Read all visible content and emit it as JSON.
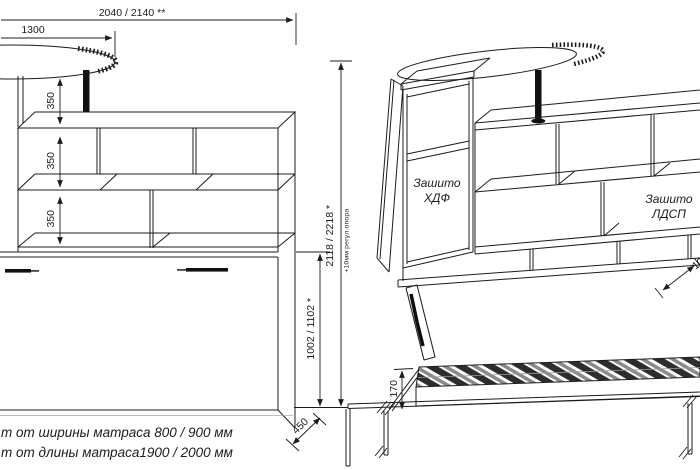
{
  "views": {
    "front": {
      "dims": {
        "total_width": "2040 / 2140 **",
        "table_width": "1300",
        "shelf_spacing": [
          "350",
          "350",
          "350"
        ],
        "bed_cabinet_height": "1002 / 1102 *",
        "total_height": "2118 / 2218 *",
        "total_height_note": "+10мм регул.опора",
        "depth": "450"
      }
    },
    "side": {
      "labels": {
        "hdf": "Зашито ХДФ",
        "ldsp": "Зашито ЛДСП"
      },
      "dims": {
        "frame_height": "170",
        "clearance": "100"
      }
    }
  },
  "footnotes": [
    "т от ширины матраса 800 / 900 мм",
    "т от длины матраса1900 / 2000 мм"
  ],
  "colors": {
    "line": "#1c1c1c",
    "slat_dark": "#2d2d2d",
    "slat_light": "#8a8a8a",
    "background": "#ffffff"
  }
}
